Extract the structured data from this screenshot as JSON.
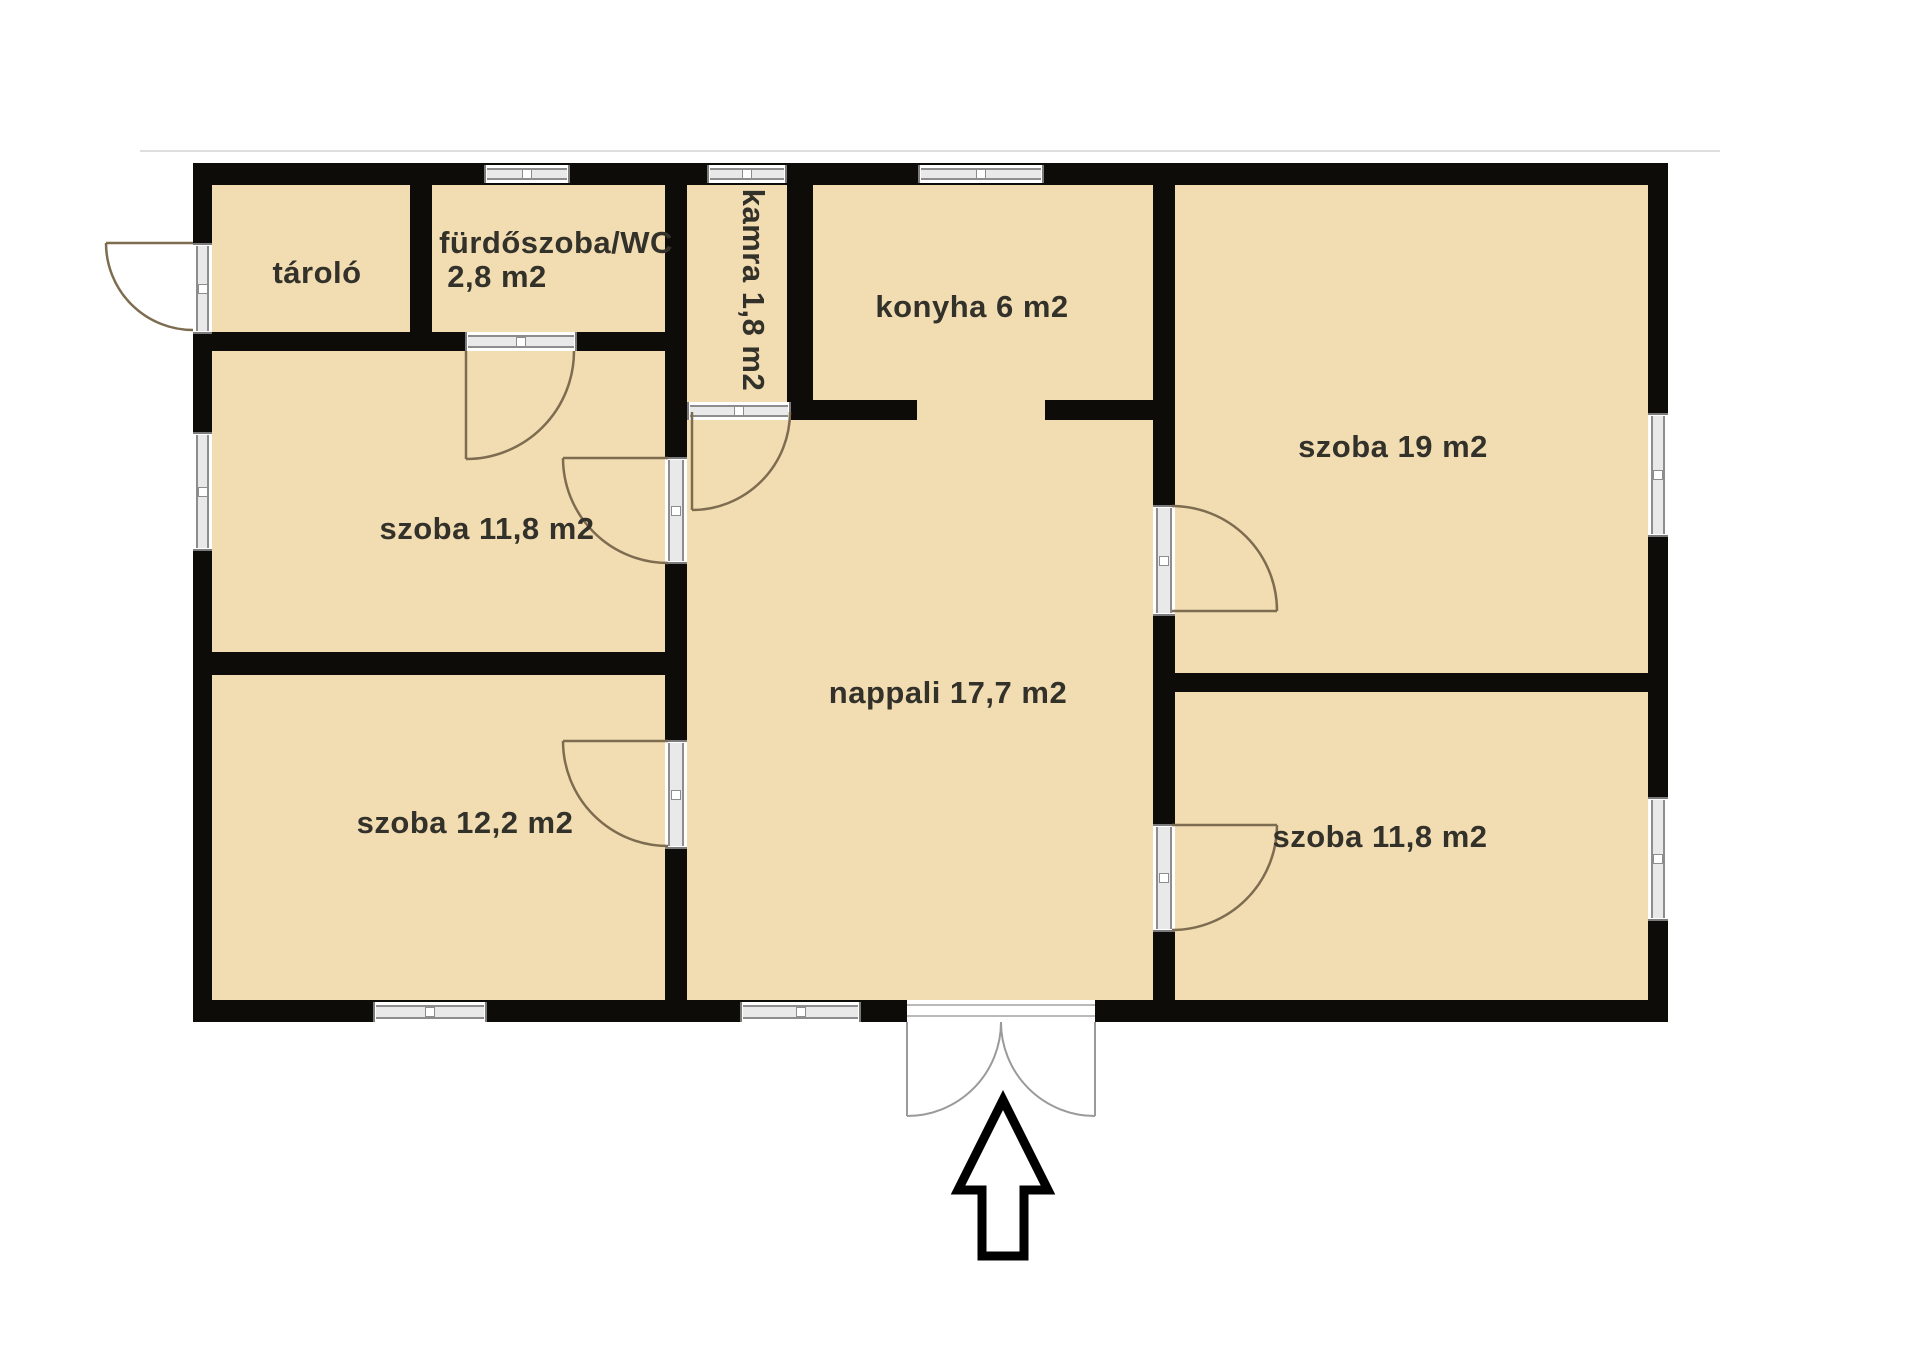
{
  "title": "Floor plan",
  "colors": {
    "room_fill": "#f2dcb2",
    "wall": "#0d0c08",
    "window_line": "#8d8d8d",
    "door_arc": "#7d6c4f",
    "label_text": "#32312a",
    "arrow_outline": "#000000",
    "background": "#ffffff"
  },
  "rooms": [
    {
      "id": "tarolo",
      "label": "tároló"
    },
    {
      "id": "furdoszoba",
      "label": "fürdőszoba/WC",
      "area_label": "2,8 m2"
    },
    {
      "id": "kamra",
      "label": "kamra 1,8 m2"
    },
    {
      "id": "konyha",
      "label": "konyha 6 m2"
    },
    {
      "id": "szoba-19",
      "label": "szoba 19 m2"
    },
    {
      "id": "szoba-11-8-left",
      "label": "szoba 11,8 m2"
    },
    {
      "id": "nappali",
      "label": "nappali 17,7 m2"
    },
    {
      "id": "szoba-12-2",
      "label": "szoba 12,2 m2"
    },
    {
      "id": "szoba-11-8-right",
      "label": "szoba 11,8 m2"
    }
  ],
  "icons": {
    "entrance_arrow": "up-arrow"
  }
}
